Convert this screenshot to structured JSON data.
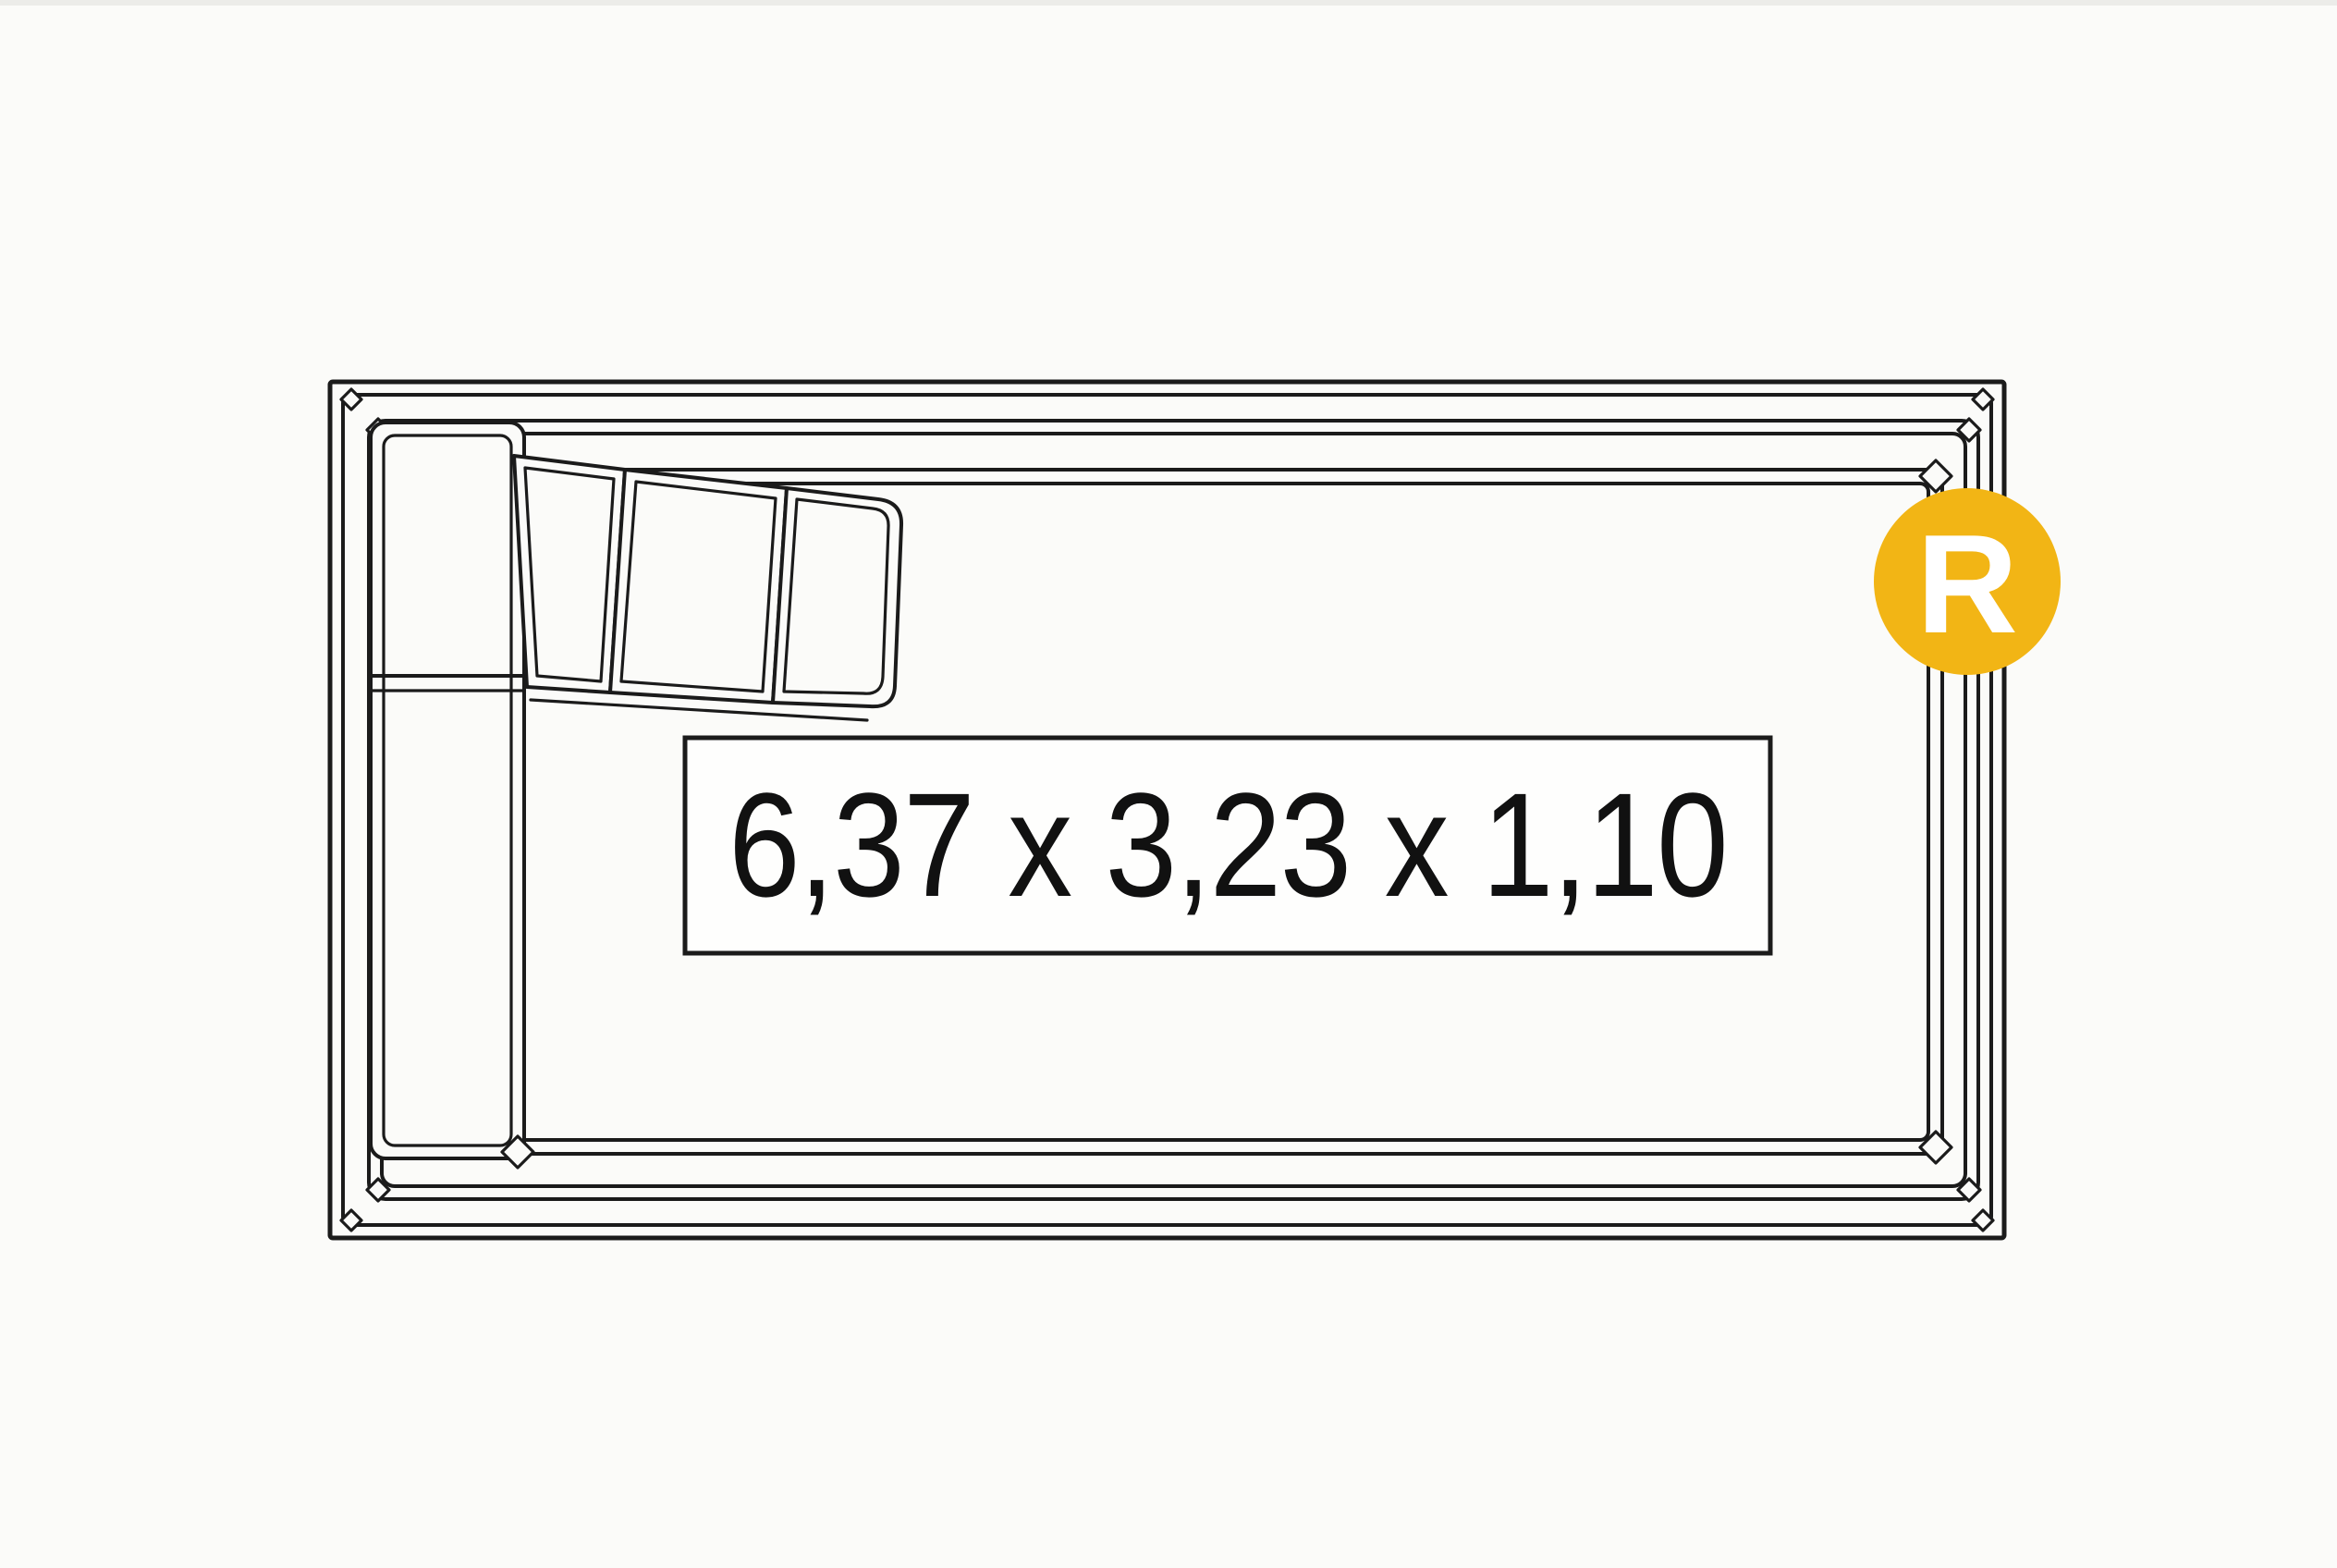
{
  "drawing": {
    "dimensions_label": "6,37 x 3,23 x 1,10",
    "badge_letter": "R"
  },
  "colors": {
    "background": "#FBFBF9",
    "line": "#1B1B1B",
    "badge_background": "#F2B515",
    "badge_letter": "#FFFFFF",
    "dimension_box_background": "#FEFEFD",
    "dimension_text": "#111111"
  }
}
